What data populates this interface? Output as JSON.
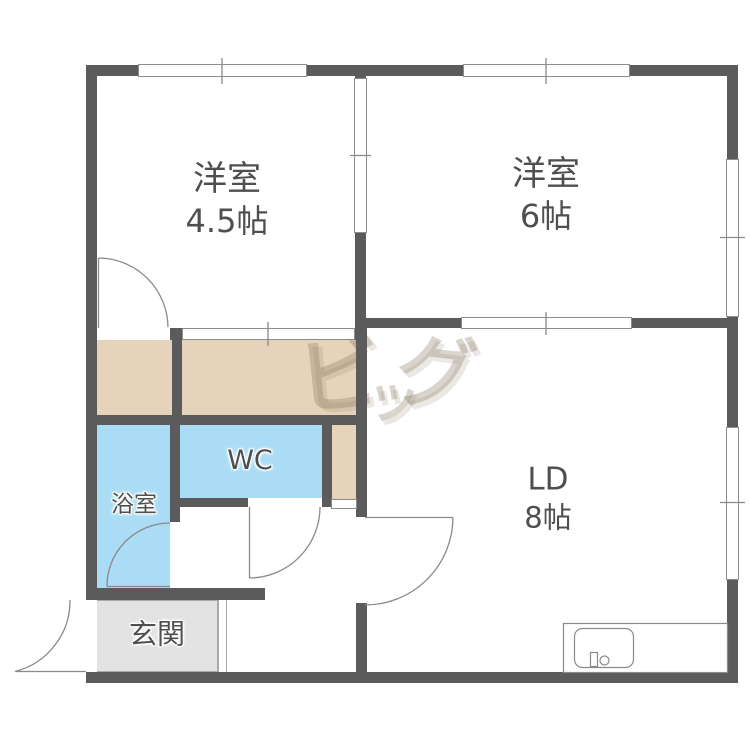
{
  "plan_type": "apartment-floorplan",
  "rooms": [
    {
      "id": "bedroom-1",
      "label": "洋室",
      "size": "4.5帖"
    },
    {
      "id": "bedroom-2",
      "label": "洋室",
      "size": "6帖"
    },
    {
      "id": "living-dining",
      "label": "LD",
      "size": "8帖"
    },
    {
      "id": "toilet",
      "label": "WC"
    },
    {
      "id": "bathroom",
      "label": "浴室"
    },
    {
      "id": "entrance",
      "label": "玄関"
    }
  ],
  "watermark": {
    "text": "ビッグ",
    "chars": [
      "ビ",
      "ッ",
      "グ"
    ]
  },
  "fixtures": [
    {
      "name": "kitchen-sink"
    },
    {
      "name": "window-symbol-count",
      "value": "6"
    },
    {
      "name": "door-swing-count",
      "value": "5"
    }
  ],
  "colors": {
    "wall": "#5c5b5b",
    "hall_floor": "#e6d3bb",
    "wet_area_floor": "#aaddf5",
    "entrance_floor": "#e3e3e3",
    "outline": "#8c8c8c",
    "label_text": "#4f4f4f",
    "watermark": "#d3bd9f"
  }
}
